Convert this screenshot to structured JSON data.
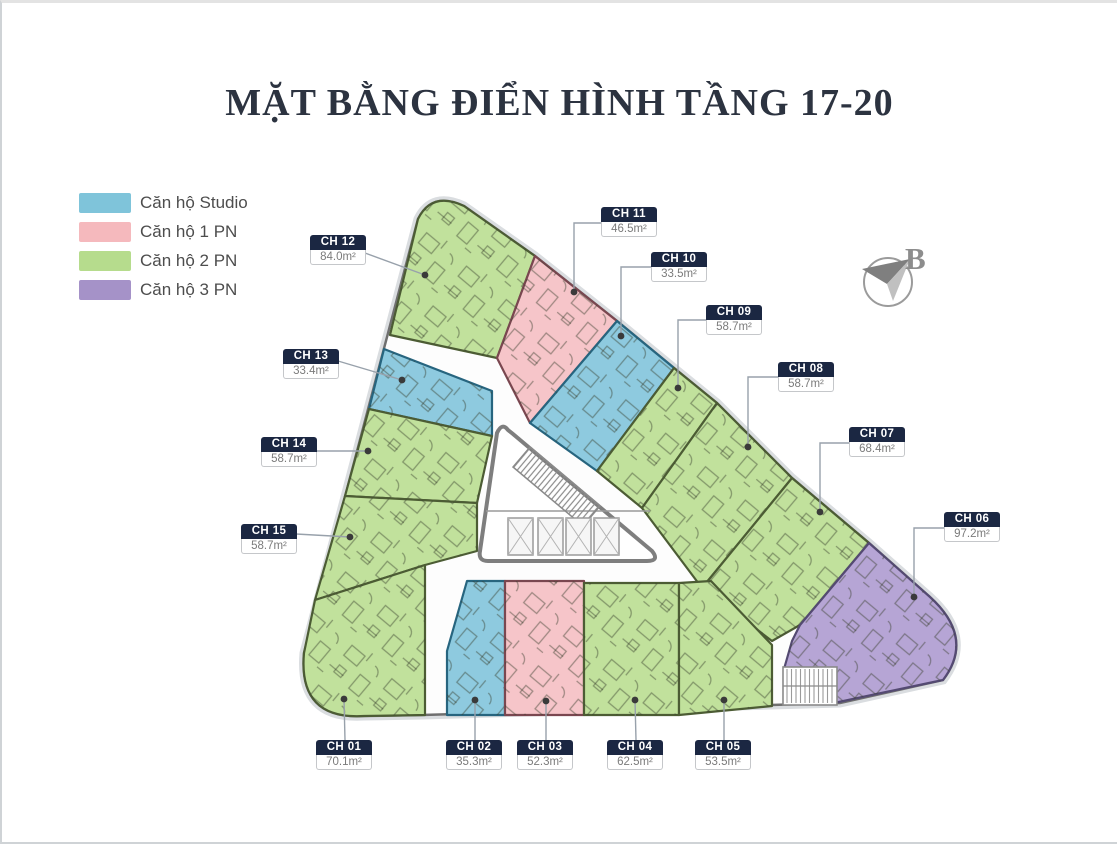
{
  "page": {
    "title": "MẶT BẰNG ĐIỂN HÌNH TẦNG 17-20"
  },
  "legend": {
    "items": [
      {
        "label": "Căn hộ Studio",
        "color": "#7fc4da"
      },
      {
        "label": "Căn hộ 1 PN",
        "color": "#f5b9bd"
      },
      {
        "label": "Căn hộ 2 PN",
        "color": "#b6dc8d"
      },
      {
        "label": "Căn hộ 3 PN",
        "color": "#a592c8"
      }
    ]
  },
  "compass": {
    "north_label": "B"
  },
  "units": [
    {
      "name": "CH 01",
      "area": "70.1m²",
      "type": "Căn hộ 2 PN"
    },
    {
      "name": "CH 02",
      "area": "35.3m²",
      "type": "Căn hộ Studio"
    },
    {
      "name": "CH 03",
      "area": "52.3m²",
      "type": "Căn hộ 1 PN"
    },
    {
      "name": "CH 04",
      "area": "62.5m²",
      "type": "Căn hộ 2 PN"
    },
    {
      "name": "CH 05",
      "area": "53.5m²",
      "type": "Căn hộ 2 PN"
    },
    {
      "name": "CH 06",
      "area": "97.2m²",
      "type": "Căn hộ 3 PN"
    },
    {
      "name": "CH 07",
      "area": "68.4m²",
      "type": "Căn hộ 2 PN"
    },
    {
      "name": "CH 08",
      "area": "58.7m²",
      "type": "Căn hộ 2 PN"
    },
    {
      "name": "CH 09",
      "area": "58.7m²",
      "type": "Căn hộ 2 PN"
    },
    {
      "name": "CH 10",
      "area": "33.5m²",
      "type": "Căn hộ Studio"
    },
    {
      "name": "CH 11",
      "area": "46.5m²",
      "type": "Căn hộ 1 PN"
    },
    {
      "name": "CH 12",
      "area": "84.0m²",
      "type": "Căn hộ 2 PN"
    },
    {
      "name": "CH 13",
      "area": "33.4m²",
      "type": "Căn hộ Studio"
    },
    {
      "name": "CH 14",
      "area": "58.7m²",
      "type": "Căn hộ 2 PN"
    },
    {
      "name": "CH 15",
      "area": "58.7m²",
      "type": "Căn hộ 2 PN"
    }
  ]
}
